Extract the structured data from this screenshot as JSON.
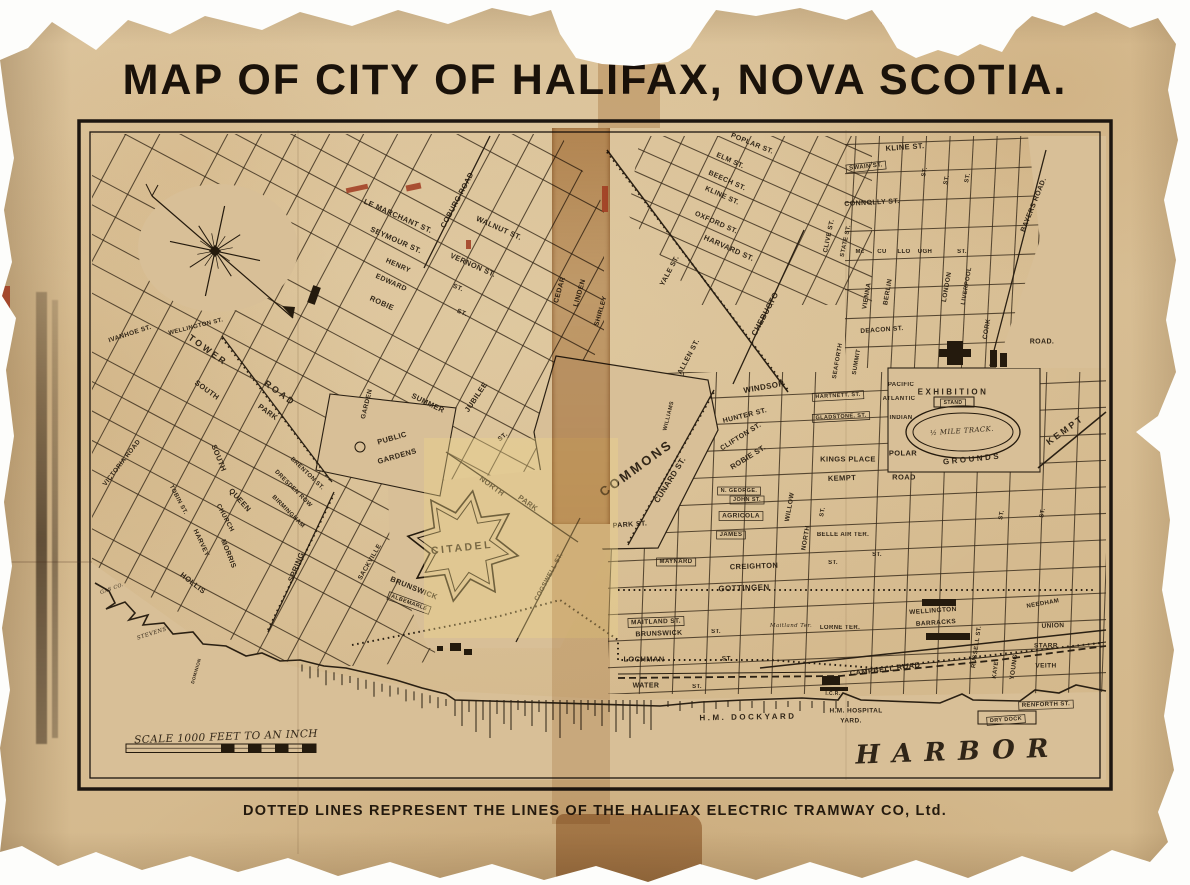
{
  "title": "MAP OF CITY OF HALIFAX, NOVA SCOTIA.",
  "caption": "DOTTED LINES REPRESENT THE LINES OF THE HALIFAX ELECTRIC TRAMWAY CO, Ltd.",
  "colors": {
    "paper": "#d8bf97",
    "ink": "#2b2114",
    "tape": "#a9713a",
    "tear_red": "#9c4a2a"
  },
  "map": {
    "labels": [
      {
        "t": "LE MARCHANT ST.",
        "x": 398,
        "y": 216,
        "r": 24,
        "s": 7.5
      },
      {
        "t": "COBURG ROAD",
        "x": 457,
        "y": 200,
        "r": -62,
        "s": 7.5
      },
      {
        "t": "WALNUT ST.",
        "x": 499,
        "y": 228,
        "r": 24,
        "s": 7.5
      },
      {
        "t": "SEYMOUR ST.",
        "x": 396,
        "y": 240,
        "r": 24,
        "s": 7.5
      },
      {
        "t": "VERNON ST.",
        "x": 473,
        "y": 265,
        "r": 24,
        "s": 7.5
      },
      {
        "t": "HENRY",
        "x": 398,
        "y": 266,
        "r": 24,
        "s": 7
      },
      {
        "t": "ST.",
        "x": 458,
        "y": 288,
        "r": 24,
        "s": 6.5
      },
      {
        "t": "EDWARD",
        "x": 391,
        "y": 283,
        "r": 24,
        "s": 7
      },
      {
        "t": "ST.",
        "x": 462,
        "y": 313,
        "r": 24,
        "s": 6.5
      },
      {
        "t": "ROBIE",
        "x": 382,
        "y": 303,
        "r": 24,
        "s": 7.5
      },
      {
        "t": "CEDAR",
        "x": 560,
        "y": 290,
        "r": -74,
        "s": 7
      },
      {
        "t": "LINDEN",
        "x": 580,
        "y": 293,
        "r": -74,
        "s": 7
      },
      {
        "t": "SHIRLEY",
        "x": 601,
        "y": 311,
        "r": -74,
        "s": 6.5
      },
      {
        "t": "POPLAR ST.",
        "x": 752,
        "y": 144,
        "r": 22,
        "s": 7
      },
      {
        "t": "ELM ST.",
        "x": 730,
        "y": 161,
        "r": 24,
        "s": 7
      },
      {
        "t": "BEECH ST.",
        "x": 727,
        "y": 181,
        "r": 24,
        "s": 7
      },
      {
        "t": "KLINE ST.",
        "x": 722,
        "y": 196,
        "r": 24,
        "s": 7
      },
      {
        "t": "OXFORD ST.",
        "x": 716,
        "y": 223,
        "r": 24,
        "s": 7
      },
      {
        "t": "HARVARD ST.",
        "x": 729,
        "y": 248,
        "r": 24,
        "s": 7.5
      },
      {
        "t": "KLINE ST.",
        "x": 905,
        "y": 147,
        "r": -4,
        "s": 7.5
      },
      {
        "t": "SWAIN ST.",
        "x": 866,
        "y": 167,
        "r": -6,
        "s": 6,
        "c": "box"
      },
      {
        "t": "CONNOLLY ST.",
        "x": 872,
        "y": 203,
        "r": -3,
        "s": 7
      },
      {
        "t": "CLIVE ST.",
        "x": 829,
        "y": 236,
        "r": -78,
        "s": 6.5
      },
      {
        "t": "STATE ST.",
        "x": 846,
        "y": 241,
        "r": -78,
        "s": 6
      },
      {
        "t": "Mc",
        "x": 860,
        "y": 252,
        "r": 0,
        "s": 6
      },
      {
        "t": "CU",
        "x": 882,
        "y": 252,
        "r": 0,
        "s": 6
      },
      {
        "t": "LLO",
        "x": 904,
        "y": 252,
        "r": 0,
        "s": 6
      },
      {
        "t": "UGH",
        "x": 925,
        "y": 252,
        "r": 0,
        "s": 6
      },
      {
        "t": "ST.",
        "x": 962,
        "y": 252,
        "r": 0,
        "s": 6
      },
      {
        "t": "ST.",
        "x": 925,
        "y": 172,
        "r": -78,
        "s": 6
      },
      {
        "t": "ST.",
        "x": 947,
        "y": 180,
        "r": -78,
        "s": 6
      },
      {
        "t": "ST.",
        "x": 968,
        "y": 178,
        "r": -78,
        "s": 6
      },
      {
        "t": "VIENNA",
        "x": 867,
        "y": 296,
        "r": -80,
        "s": 6.5
      },
      {
        "t": "BERLIN",
        "x": 888,
        "y": 292,
        "r": -80,
        "s": 6.5
      },
      {
        "t": "LONDON",
        "x": 947,
        "y": 287,
        "r": -80,
        "s": 6.5
      },
      {
        "t": "LIVERPOOL",
        "x": 967,
        "y": 286,
        "r": -80,
        "s": 6
      },
      {
        "t": "CORK",
        "x": 987,
        "y": 329,
        "r": -80,
        "s": 6.5
      },
      {
        "t": "BAYERS ROAD.",
        "x": 1034,
        "y": 205,
        "r": -68,
        "s": 7
      },
      {
        "t": "ROAD.",
        "x": 1042,
        "y": 342,
        "r": 0,
        "s": 7
      },
      {
        "t": "DEACON ST.",
        "x": 882,
        "y": 330,
        "r": -4,
        "s": 6.5
      },
      {
        "t": "SEAFORTH",
        "x": 838,
        "y": 361,
        "r": -80,
        "s": 6
      },
      {
        "t": "SUMMIT",
        "x": 857,
        "y": 362,
        "r": -80,
        "s": 6
      },
      {
        "t": "YALE ST.",
        "x": 670,
        "y": 271,
        "r": -62,
        "s": 7
      },
      {
        "t": "CHEBUCTO",
        "x": 765,
        "y": 314,
        "r": -62,
        "s": 8
      },
      {
        "t": "ALLEN ST.",
        "x": 689,
        "y": 357,
        "r": -62,
        "s": 7
      },
      {
        "t": "WINDSOR",
        "x": 764,
        "y": 387,
        "r": -10,
        "s": 8
      },
      {
        "t": "HUNTER ST.",
        "x": 745,
        "y": 416,
        "r": -14,
        "s": 7
      },
      {
        "t": "CLIFTON ST.",
        "x": 741,
        "y": 437,
        "r": -32,
        "s": 7
      },
      {
        "t": "ROBIE ST.",
        "x": 748,
        "y": 457,
        "r": -32,
        "s": 7.5
      },
      {
        "t": "HARTNETT. ST.",
        "x": 838,
        "y": 396,
        "r": -3,
        "s": 5.5,
        "c": "box"
      },
      {
        "t": "GLADSTONE. ST.",
        "x": 841,
        "y": 417,
        "r": -3,
        "s": 5.5,
        "c": "box"
      },
      {
        "t": "PACIFIC",
        "x": 901,
        "y": 385,
        "r": 0,
        "s": 6
      },
      {
        "t": "ATLANTIC",
        "x": 899,
        "y": 399,
        "r": 0,
        "s": 6
      },
      {
        "t": "INDIAN",
        "x": 901,
        "y": 418,
        "r": 0,
        "s": 6
      },
      {
        "t": "EXHIBITION",
        "x": 953,
        "y": 392,
        "r": 0,
        "s": 8,
        "c": "sp"
      },
      {
        "t": "STAND",
        "x": 953,
        "y": 403,
        "r": 0,
        "s": 5,
        "c": "box"
      },
      {
        "t": "½ MILE TRACK.",
        "x": 962,
        "y": 431,
        "r": -4,
        "s": 7,
        "c": "it"
      },
      {
        "t": "GROUNDS",
        "x": 972,
        "y": 459,
        "r": -6,
        "s": 8,
        "c": "sp"
      },
      {
        "t": "KEMPT",
        "x": 1065,
        "y": 430,
        "r": -36,
        "s": 9,
        "c": "sp"
      },
      {
        "t": "KINGS PLACE",
        "x": 848,
        "y": 459,
        "r": 0,
        "s": 7.5
      },
      {
        "t": "POLAR",
        "x": 903,
        "y": 453,
        "r": 0,
        "s": 7.5
      },
      {
        "t": "KEMPT",
        "x": 842,
        "y": 478,
        "r": -2,
        "s": 7.5
      },
      {
        "t": "ROAD",
        "x": 904,
        "y": 477,
        "r": 0,
        "s": 7.5
      },
      {
        "t": "COMMONS",
        "x": 636,
        "y": 468,
        "r": -36,
        "s": 13,
        "c": "sp"
      },
      {
        "t": "CUNARD ST.",
        "x": 670,
        "y": 480,
        "r": -58,
        "s": 8
      },
      {
        "t": "WILLIAMS",
        "x": 669,
        "y": 416,
        "r": -76,
        "s": 5.5
      },
      {
        "t": "PARK ST.",
        "x": 630,
        "y": 525,
        "r": -4,
        "s": 7
      },
      {
        "t": "N. GEORGE.",
        "x": 739,
        "y": 491,
        "r": 0,
        "s": 5.5,
        "c": "box"
      },
      {
        "t": "JOHN ST.",
        "x": 747,
        "y": 500,
        "r": 0,
        "s": 5.5,
        "c": "box"
      },
      {
        "t": "AGRICOLA",
        "x": 741,
        "y": 516,
        "r": 0,
        "s": 6.5,
        "c": "box"
      },
      {
        "t": "JAMES",
        "x": 731,
        "y": 535,
        "r": 0,
        "s": 6,
        "c": "box"
      },
      {
        "t": "BELLE AIR TER.",
        "x": 843,
        "y": 535,
        "r": 0,
        "s": 6
      },
      {
        "t": "MAYNARD",
        "x": 676,
        "y": 562,
        "r": 0,
        "s": 6,
        "c": "box"
      },
      {
        "t": "CREIGHTON",
        "x": 754,
        "y": 566,
        "r": -2,
        "s": 7.5
      },
      {
        "t": "GOTTINGEN",
        "x": 744,
        "y": 588,
        "r": -2,
        "s": 8
      },
      {
        "t": "NORTH",
        "x": 806,
        "y": 538,
        "r": -80,
        "s": 6.5
      },
      {
        "t": "WILLOW",
        "x": 790,
        "y": 507,
        "r": -80,
        "s": 6.5
      },
      {
        "t": "ST.",
        "x": 833,
        "y": 563,
        "r": 0,
        "s": 6
      },
      {
        "t": "ST.",
        "x": 877,
        "y": 555,
        "r": 0,
        "s": 6
      },
      {
        "t": "ST.",
        "x": 823,
        "y": 512,
        "r": -80,
        "s": 6
      },
      {
        "t": "ST.",
        "x": 1002,
        "y": 515,
        "r": -80,
        "s": 6
      },
      {
        "t": "ST.",
        "x": 1043,
        "y": 513,
        "r": -80,
        "s": 6
      },
      {
        "t": "MAITLAND ST.",
        "x": 656,
        "y": 622,
        "r": -2,
        "s": 6.5,
        "c": "box"
      },
      {
        "t": "BRUNSWICK",
        "x": 659,
        "y": 634,
        "r": -2,
        "s": 7
      },
      {
        "t": "ST.",
        "x": 716,
        "y": 632,
        "r": 0,
        "s": 6
      },
      {
        "t": "LOCHMAN",
        "x": 644,
        "y": 659,
        "r": 0,
        "s": 7.5
      },
      {
        "t": "ST.",
        "x": 727,
        "y": 659,
        "r": 0,
        "s": 6.5
      },
      {
        "t": "WATER",
        "x": 646,
        "y": 686,
        "r": 0,
        "s": 7
      },
      {
        "t": "ST.",
        "x": 697,
        "y": 687,
        "r": 0,
        "s": 6
      },
      {
        "t": "Maitland Ter.",
        "x": 791,
        "y": 626,
        "r": 0,
        "s": 5.5,
        "c": "it"
      },
      {
        "t": "LORNE TER.",
        "x": 840,
        "y": 628,
        "r": 0,
        "s": 6
      },
      {
        "t": "CAMPBELL ROAD",
        "x": 885,
        "y": 669,
        "r": -7,
        "s": 7.5
      },
      {
        "t": "WELLINGTON",
        "x": 933,
        "y": 611,
        "r": -4,
        "s": 6.5
      },
      {
        "t": "BARRACKS",
        "x": 936,
        "y": 623,
        "r": -4,
        "s": 6.5
      },
      {
        "t": "RUSSELL ST.",
        "x": 977,
        "y": 647,
        "r": -82,
        "s": 6
      },
      {
        "t": "KAYE",
        "x": 996,
        "y": 670,
        "r": -82,
        "s": 6
      },
      {
        "t": "YOUNG",
        "x": 1014,
        "y": 667,
        "r": -82,
        "s": 6.5
      },
      {
        "t": "NEEDHAM",
        "x": 1043,
        "y": 604,
        "r": -10,
        "s": 6
      },
      {
        "t": "UNION",
        "x": 1053,
        "y": 626,
        "r": -2,
        "s": 6.5
      },
      {
        "t": "STARR",
        "x": 1046,
        "y": 646,
        "r": 0,
        "s": 6.5
      },
      {
        "t": "VEITH",
        "x": 1046,
        "y": 666,
        "r": 0,
        "s": 6.5
      },
      {
        "t": "RENFORTH ST.",
        "x": 1046,
        "y": 705,
        "r": -2,
        "s": 6,
        "c": "box"
      },
      {
        "t": "H.M. DOCKYARD",
        "x": 748,
        "y": 717,
        "r": -1,
        "s": 8,
        "c": "sp"
      },
      {
        "t": "H.M. HOSPITAL",
        "x": 856,
        "y": 711,
        "r": 0,
        "s": 6.5
      },
      {
        "t": "YARD.",
        "x": 851,
        "y": 721,
        "r": 0,
        "s": 6.5
      },
      {
        "t": "DRY DOCK",
        "x": 1006,
        "y": 720,
        "r": -4,
        "s": 5.5,
        "c": "box"
      },
      {
        "t": "HARBOR",
        "x": 958,
        "y": 752,
        "r": -2,
        "s": 26,
        "c": "harbor"
      },
      {
        "t": "I.C.R.",
        "x": 833,
        "y": 694,
        "r": 0,
        "s": 5
      },
      {
        "t": "TOWER",
        "x": 208,
        "y": 350,
        "r": 36,
        "s": 9,
        "c": "sp"
      },
      {
        "t": "ROAD",
        "x": 280,
        "y": 393,
        "r": 36,
        "s": 9,
        "c": "sp"
      },
      {
        "t": "SOUTH",
        "x": 207,
        "y": 390,
        "r": 36,
        "s": 7.5
      },
      {
        "t": "PARK",
        "x": 268,
        "y": 412,
        "r": 36,
        "s": 7.5
      },
      {
        "t": "IVANHOE ST.",
        "x": 130,
        "y": 334,
        "r": -18,
        "s": 6.5
      },
      {
        "t": "WELLINGTON ST.",
        "x": 196,
        "y": 327,
        "r": -14,
        "s": 6
      },
      {
        "t": "VICTORIA ROAD",
        "x": 122,
        "y": 463,
        "r": -52,
        "s": 6.5
      },
      {
        "t": "SOUTH",
        "x": 219,
        "y": 458,
        "r": 68,
        "s": 7.5
      },
      {
        "t": "QUEEN",
        "x": 240,
        "y": 500,
        "r": 48,
        "s": 7.5
      },
      {
        "t": "CHURCH",
        "x": 225,
        "y": 518,
        "r": 62,
        "s": 6.5
      },
      {
        "t": "HARVEY",
        "x": 201,
        "y": 543,
        "r": 65,
        "s": 6.5
      },
      {
        "t": "MORRIS",
        "x": 228,
        "y": 554,
        "r": 68,
        "s": 7
      },
      {
        "t": "HOLLIS",
        "x": 193,
        "y": 583,
        "r": 38,
        "s": 7.5
      },
      {
        "t": "TOBIN ST.",
        "x": 178,
        "y": 500,
        "r": 62,
        "s": 6
      },
      {
        "t": "SPRING",
        "x": 296,
        "y": 567,
        "r": -68,
        "s": 7.5
      },
      {
        "t": "GARDEN",
        "x": 367,
        "y": 404,
        "r": -76,
        "s": 6.5
      },
      {
        "t": "SACKVILLE",
        "x": 370,
        "y": 562,
        "r": -60,
        "s": 6.5
      },
      {
        "t": "BRENTON ST.",
        "x": 307,
        "y": 474,
        "r": 44,
        "s": 6
      },
      {
        "t": "DRESDEN ROW",
        "x": 293,
        "y": 489,
        "r": 45,
        "s": 6
      },
      {
        "t": "BIRMINGHAM",
        "x": 288,
        "y": 512,
        "r": 45,
        "s": 6
      },
      {
        "t": "BRUNSWICK",
        "x": 414,
        "y": 588,
        "r": 22,
        "s": 7.5
      },
      {
        "t": "ALBEMARLE",
        "x": 409,
        "y": 603,
        "r": 20,
        "s": 5.5,
        "c": "box"
      },
      {
        "t": "COGSWELL ST.",
        "x": 549,
        "y": 577,
        "r": -62,
        "s": 6.5
      },
      {
        "t": "NORTH",
        "x": 492,
        "y": 486,
        "r": 36,
        "s": 7.5
      },
      {
        "t": "PARK",
        "x": 528,
        "y": 503,
        "r": 36,
        "s": 7.5
      },
      {
        "t": "CITADEL",
        "x": 462,
        "y": 548,
        "r": -6,
        "s": 10.5,
        "c": "sp"
      },
      {
        "t": "PUBLIC",
        "x": 392,
        "y": 438,
        "r": -16,
        "s": 7.5
      },
      {
        "t": "GARDENS",
        "x": 397,
        "y": 456,
        "r": -16,
        "s": 7.5
      },
      {
        "t": "SUMMER",
        "x": 428,
        "y": 403,
        "r": 26,
        "s": 7.5
      },
      {
        "t": "JUBILEE",
        "x": 476,
        "y": 397,
        "r": -56,
        "s": 7.5
      },
      {
        "t": "ST.",
        "x": 503,
        "y": 437,
        "r": -40,
        "s": 6.5
      },
      {
        "t": "GAS CO.",
        "x": 112,
        "y": 589,
        "r": -20,
        "s": 5,
        "c": "it"
      },
      {
        "t": "STEVENS",
        "x": 152,
        "y": 634,
        "r": -18,
        "s": 5.5,
        "c": "it"
      },
      {
        "t": "DOMINION",
        "x": 196,
        "y": 671,
        "r": -74,
        "s": 4.5
      },
      {
        "t": "SCALE 1000 FEET TO AN INCH",
        "x": 226,
        "y": 737,
        "r": -2,
        "s": 10.5,
        "c": "it"
      }
    ]
  }
}
